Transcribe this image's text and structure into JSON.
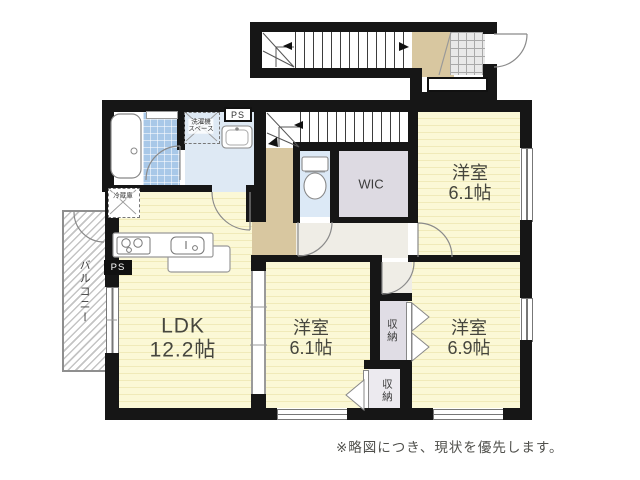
{
  "plan": {
    "note": "※略図につき、現状を優先します。",
    "rooms": {
      "ldk": {
        "name": "LDK",
        "size": "12.2帖"
      },
      "bedroom_top": {
        "name": "洋室",
        "size": "6.1帖"
      },
      "bedroom_mid": {
        "name": "洋室",
        "size": "6.1帖"
      },
      "bedroom_right": {
        "name": "洋室",
        "size": "6.9帖"
      },
      "wic": {
        "name": "WIC"
      },
      "closet_top": {
        "name": "収納"
      },
      "closet_bottom": {
        "name": "収納"
      },
      "balcony": {
        "name": "バルコニー"
      }
    },
    "fixtures": {
      "fridge_label": "冷蔵庫",
      "washer_label_line1": "洗濯機",
      "washer_label_line2": "スペース",
      "ps_washroom": "PS",
      "ps_ldk": "PS"
    },
    "colors": {
      "wall": "#161616",
      "room_yellow": "#fbf8d6",
      "hall_tan": "#d8c7a0",
      "wet_area_blue": "#dee9f4",
      "bath_tile_blue": "#a8c8e8",
      "closet_gray": "#e0dde5"
    }
  }
}
